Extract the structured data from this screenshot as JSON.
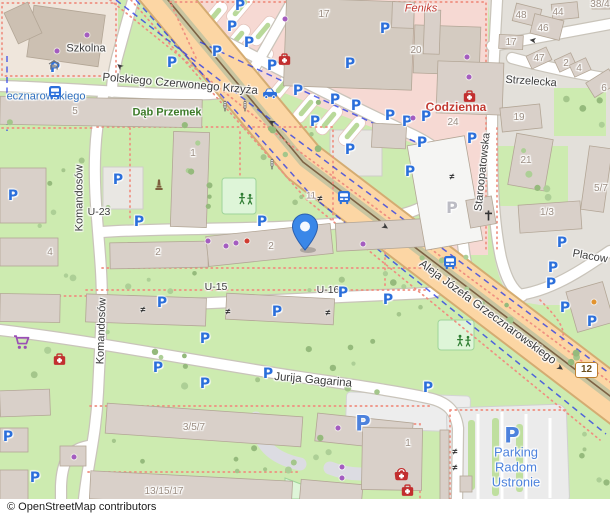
{
  "map": {
    "attribution": "© OpenStreetMap contributors",
    "badge": {
      "text": "12"
    },
    "marker": {
      "x": 305,
      "y": 250,
      "color": "#3a87e8"
    },
    "palette": {
      "road_primary": "#fcd6a4",
      "grass": "#cdebb0",
      "retail": "#f6d9d3",
      "parking_blue": "#2b6fdb",
      "parking_text_blue": "#4d82dd",
      "pharmacy_red": "#c22f2f",
      "shop_purple": "#a45cc0",
      "street_text": "#3c3c3c",
      "number_text": "#9b8d82",
      "green_text": "#3c7a28",
      "red_text": "#c23a32",
      "transit_blue_text": "#2f6fbe",
      "footpath_salmon": "#ef8f80",
      "cycleway_blue": "#2336e8"
    },
    "symbols": {
      "parking_char": "P",
      "gate_char": "≠",
      "arrow_char": "➤"
    },
    "street_labels": [
      {
        "t": "Polskiego Czerwonego Krzyża",
        "x": 180,
        "y": 85,
        "r": 5,
        "c": "st",
        "s": 11.5
      },
      {
        "t": "Szkolna",
        "x": 86,
        "y": 49,
        "c": "st",
        "s": 11
      },
      {
        "t": "ecznarowskiego",
        "x": 46,
        "y": 97,
        "c": "blu",
        "s": 11
      },
      {
        "t": "Dąb Przemek",
        "x": 167,
        "y": 113,
        "c": "grn",
        "s": 11,
        "b": 1
      },
      {
        "t": "Komandosów",
        "x": 80,
        "y": 198,
        "r": -90,
        "c": "st",
        "s": 11
      },
      {
        "t": "Komandosów",
        "x": 102,
        "y": 331,
        "r": -88,
        "c": "st",
        "s": 11
      },
      {
        "t": "U-23",
        "x": 99,
        "y": 212,
        "c": "st",
        "s": 10.5
      },
      {
        "t": "U-15",
        "x": 216,
        "y": 287,
        "c": "st",
        "s": 10.5
      },
      {
        "t": "U-16",
        "x": 328,
        "y": 290,
        "c": "st",
        "s": 10.5
      },
      {
        "t": "Jurija Gagarina",
        "x": 313,
        "y": 381,
        "r": 5,
        "c": "st",
        "s": 11.5
      },
      {
        "t": "Aleja Józefa Grzecznarowskiego",
        "x": 487,
        "y": 313,
        "r": 36.5,
        "c": "st",
        "s": 11.5
      },
      {
        "t": "Staroopatowska",
        "x": 483,
        "y": 172,
        "r": -84,
        "c": "st",
        "s": 11
      },
      {
        "t": "Strzelecka",
        "x": 531,
        "y": 82,
        "r": 4,
        "c": "st",
        "s": 11
      },
      {
        "t": "Placow",
        "x": 590,
        "y": 257,
        "r": 10,
        "c": "st",
        "s": 11
      },
      {
        "t": "Feniks",
        "x": 421,
        "y": 9,
        "c": "red",
        "s": 11,
        "i": 1
      },
      {
        "t": "Codzienna",
        "x": 456,
        "y": 107,
        "c": "red",
        "s": 12,
        "b": 1
      },
      {
        "t": "Parking",
        "x": 516,
        "y": 452,
        "c": "pkg",
        "s": 13
      },
      {
        "t": "Radom",
        "x": 516,
        "y": 467,
        "c": "pkg",
        "s": 13
      },
      {
        "t": "Ustronie",
        "x": 516,
        "y": 482,
        "c": "pkg",
        "s": 13
      },
      {
        "t": "5",
        "x": 75,
        "y": 112,
        "c": "num",
        "s": 10
      },
      {
        "t": "17",
        "x": 324,
        "y": 15,
        "c": "num",
        "s": 10
      },
      {
        "t": "20",
        "x": 416,
        "y": 51,
        "c": "num",
        "s": 10
      },
      {
        "t": "24",
        "x": 453,
        "y": 123,
        "c": "num",
        "s": 10
      },
      {
        "t": "48",
        "x": 521,
        "y": 16,
        "c": "num",
        "s": 10
      },
      {
        "t": "44",
        "x": 558,
        "y": 13,
        "c": "num",
        "s": 10
      },
      {
        "t": "46",
        "x": 543,
        "y": 29,
        "c": "num",
        "s": 10
      },
      {
        "t": "17",
        "x": 511,
        "y": 43,
        "c": "num",
        "s": 10
      },
      {
        "t": "47",
        "x": 539,
        "y": 59,
        "c": "num",
        "s": 10
      },
      {
        "t": "2",
        "x": 566,
        "y": 64,
        "c": "num",
        "s": 10
      },
      {
        "t": "4",
        "x": 579,
        "y": 69,
        "c": "num",
        "s": 10
      },
      {
        "t": "6",
        "x": 604,
        "y": 89,
        "c": "num",
        "s": 10
      },
      {
        "t": "38/4",
        "x": 600,
        "y": 5,
        "c": "num",
        "s": 10
      },
      {
        "t": "19",
        "x": 519,
        "y": 118,
        "c": "num",
        "s": 10
      },
      {
        "t": "21",
        "x": 526,
        "y": 161,
        "c": "num",
        "s": 10
      },
      {
        "t": "1/3",
        "x": 547,
        "y": 213,
        "c": "num",
        "s": 10
      },
      {
        "t": "5/7",
        "x": 601,
        "y": 189,
        "c": "num",
        "s": 10
      },
      {
        "t": "1",
        "x": 193,
        "y": 154,
        "c": "num",
        "s": 10
      },
      {
        "t": "4",
        "x": 50,
        "y": 253,
        "c": "num",
        "s": 10
      },
      {
        "t": "2",
        "x": 158,
        "y": 253,
        "c": "num",
        "s": 10
      },
      {
        "t": "2",
        "x": 271,
        "y": 247,
        "c": "num",
        "s": 10
      },
      {
        "t": "11",
        "x": 311,
        "y": 196,
        "c": "num",
        "s": 9.5
      },
      {
        "t": "3/5/7",
        "x": 194,
        "y": 428,
        "c": "num",
        "s": 10
      },
      {
        "t": "13/15/17",
        "x": 164,
        "y": 492,
        "c": "num",
        "s": 10
      },
      {
        "t": "1",
        "x": 408,
        "y": 444,
        "c": "num",
        "s": 10
      }
    ],
    "parking_icons": [
      [
        55,
        68
      ],
      [
        172,
        63
      ],
      [
        272,
        66
      ],
      [
        350,
        64
      ],
      [
        240,
        6
      ],
      [
        232,
        27
      ],
      [
        249,
        43
      ],
      [
        217,
        52
      ],
      [
        298,
        91
      ],
      [
        335,
        100
      ],
      [
        356,
        106
      ],
      [
        315,
        122
      ],
      [
        385,
        29
      ],
      [
        390,
        116
      ],
      [
        407,
        122
      ],
      [
        426,
        117
      ],
      [
        422,
        143
      ],
      [
        410,
        172
      ],
      [
        472,
        139
      ],
      [
        562,
        243
      ],
      [
        553,
        268
      ],
      [
        551,
        284
      ],
      [
        565,
        308
      ],
      [
        592,
        322
      ],
      [
        13,
        196
      ],
      [
        118,
        180
      ],
      [
        139,
        222
      ],
      [
        262,
        222
      ],
      [
        350,
        150
      ],
      [
        162,
        303
      ],
      [
        277,
        312
      ],
      [
        205,
        339
      ],
      [
        343,
        293
      ],
      [
        388,
        300
      ],
      [
        158,
        368
      ],
      [
        268,
        374
      ],
      [
        205,
        384
      ],
      [
        8,
        437
      ],
      [
        35,
        478
      ],
      [
        428,
        388
      ]
    ],
    "parking_icons_big": [
      [
        363,
        424
      ],
      [
        512,
        436
      ]
    ],
    "parking_icons_gray": [
      [
        452,
        208
      ]
    ],
    "pois": [
      {
        "k": "bus",
        "x": 48,
        "y": 85
      },
      {
        "k": "bus",
        "x": 337,
        "y": 190
      },
      {
        "k": "bus",
        "x": 443,
        "y": 255
      },
      {
        "k": "shelter",
        "x": 48,
        "y": 60
      },
      {
        "k": "taxi",
        "x": 262,
        "y": 86
      },
      {
        "k": "signals",
        "x": 221,
        "y": 100
      },
      {
        "k": "signals",
        "x": 241,
        "y": 100
      },
      {
        "k": "signals",
        "x": 268,
        "y": 158
      },
      {
        "k": "pharmacy",
        "x": 278,
        "y": 53
      },
      {
        "k": "pharmacy",
        "x": 463,
        "y": 90
      },
      {
        "k": "pharmacy",
        "x": 53,
        "y": 353
      },
      {
        "k": "pharmacy",
        "x": 401,
        "y": 484
      },
      {
        "k": "doctors",
        "x": 394,
        "y": 468
      },
      {
        "k": "cart",
        "x": 13,
        "y": 335
      },
      {
        "k": "monument",
        "x": 154,
        "y": 179
      },
      {
        "k": "cross",
        "x": 484,
        "y": 210
      },
      {
        "k": "playground",
        "x": 237,
        "y": 192
      },
      {
        "k": "playground",
        "x": 455,
        "y": 334
      },
      {
        "k": "playground",
        "x": 310,
        "y": 500
      }
    ],
    "shop_dots_purple": [
      [
        57,
        51
      ],
      [
        87,
        35
      ],
      [
        285,
        19
      ],
      [
        467,
        57
      ],
      [
        469,
        77
      ],
      [
        208,
        241
      ],
      [
        226,
        246
      ],
      [
        236,
        243
      ],
      [
        363,
        244
      ],
      [
        413,
        118
      ],
      [
        338,
        428
      ],
      [
        342,
        467
      ],
      [
        342,
        478
      ],
      [
        74,
        457
      ]
    ],
    "poi_dots_red": [
      [
        247,
        241
      ]
    ],
    "poi_dots_orange": [
      [
        594,
        302
      ]
    ],
    "gates": [
      [
        320,
        199
      ],
      [
        143,
        310
      ],
      [
        228,
        312
      ],
      [
        328,
        313
      ],
      [
        452,
        177
      ],
      [
        455,
        452
      ],
      [
        455,
        468
      ]
    ],
    "arrows": [
      {
        "x": 272,
        "y": 122,
        "r": 212
      },
      {
        "x": 385,
        "y": 227,
        "r": 33
      },
      {
        "x": 560,
        "y": 368,
        "r": 34
      },
      {
        "x": 533,
        "y": 40,
        "r": 187
      },
      {
        "x": 120,
        "y": 66,
        "r": 220
      }
    ]
  }
}
